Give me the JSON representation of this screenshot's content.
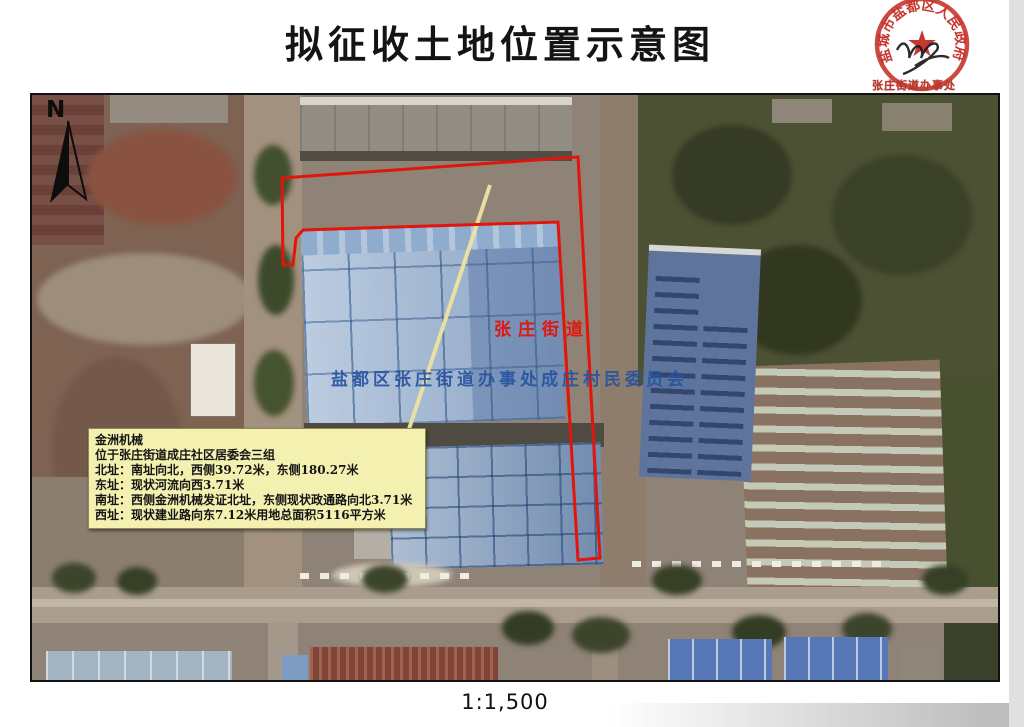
{
  "title": "拟征收土地位置示意图",
  "scale_label": "1:1,500",
  "compass": {
    "label": "N"
  },
  "seal": {
    "ring_text": "盐城市盐都区人民政府",
    "star_glyph": "★",
    "secondary_stamp": "张庄街道办事处"
  },
  "map": {
    "street_label": "张庄街道",
    "committee_label": "盐都区张庄街道办事处成庄村民委员会"
  },
  "infobox": {
    "name": "金洲机械",
    "location": "位于张庄街道成庄社区居委会三组",
    "north": "北址：南址向北，西侧39.72米，东侧180.27米",
    "east": "东址：现状河流向西3.71米",
    "south": "南址：西侧金洲机械发证北址，东侧现状政通路向北3.71米",
    "west": "西址：现状建业路向东7.12米用地总面积5116平方米"
  },
  "colors": {
    "boundary_red": "#e1150c",
    "leader_yellow": "#ece5a0",
    "seal_red": "#c5372f",
    "infobox_yellow": "#f4f0b0",
    "street_label_red": "#e0180f",
    "committee_label_blue": "#26549e"
  }
}
